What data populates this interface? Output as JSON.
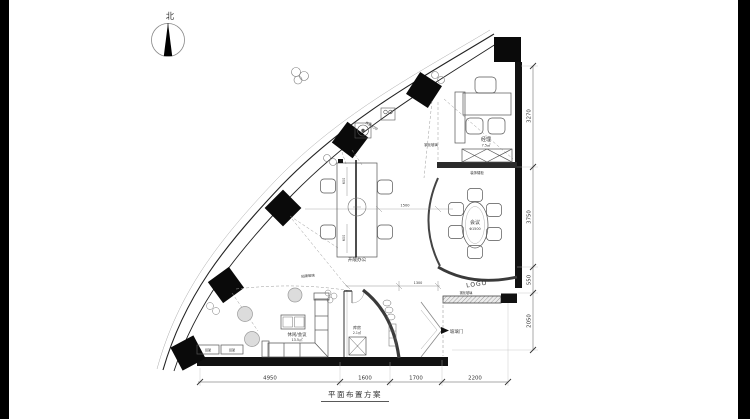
{
  "compass": {
    "label": "北"
  },
  "title": {
    "text": "平面布置方案"
  },
  "rooms": {
    "manager": {
      "name": "经理",
      "area": "7.5㎡"
    },
    "meeting": {
      "name": "会议",
      "size": "Φ1500"
    },
    "open_office": {
      "name": "开敞办公"
    },
    "lounge": {
      "name": "休闲/会议",
      "area": "13.5㎡"
    },
    "storage": {
      "name": "库房",
      "area": "2.1㎡"
    }
  },
  "annotations": {
    "logo_wall": "LOGO",
    "glass_door": "玻璃门",
    "tempered_glass": "钢化玻璃",
    "film_glass": "贴膜玻璃",
    "low_cabinet": "装饰矮柜",
    "fax_print": "传真/打印",
    "shelf": "货架"
  },
  "dimensions": {
    "bottom": [
      {
        "value": "4950"
      },
      {
        "value": "1600"
      },
      {
        "value": "1700"
      },
      {
        "value": "2200"
      }
    ],
    "right": [
      {
        "value": "3270"
      },
      {
        "value": "3750"
      },
      {
        "value": "550"
      },
      {
        "value": "2050"
      }
    ],
    "internal": {
      "desk_gap": "1500",
      "desk_bay": "600",
      "entry_door": "1300"
    }
  }
}
